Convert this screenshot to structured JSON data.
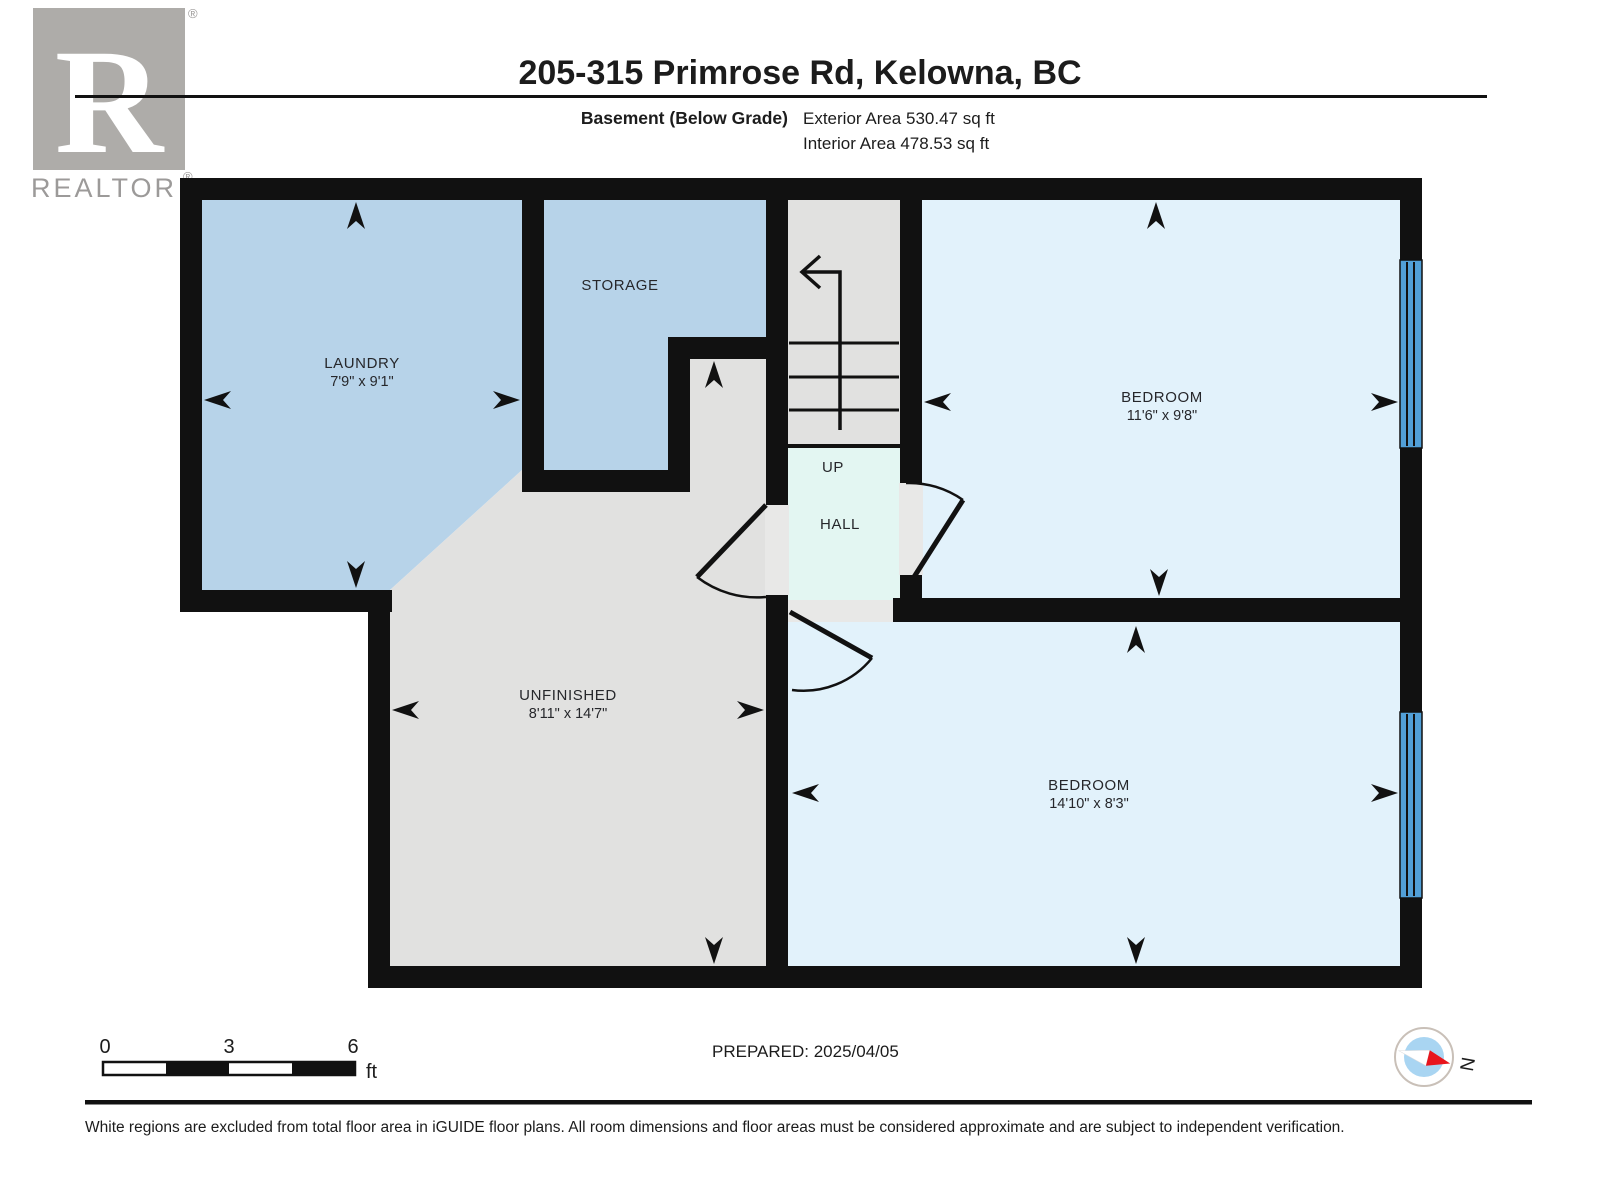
{
  "header": {
    "title": "205-315 Primrose Rd, Kelowna, BC",
    "floor_label": "Basement (Below Grade)",
    "exterior_area": "Exterior Area 530.47 sq ft",
    "interior_area": "Interior Area 478.53 sq ft"
  },
  "logo": {
    "letter": "R",
    "word": "REALTOR",
    "registered": "®"
  },
  "plan": {
    "laundry": {
      "name": "LAUNDRY",
      "dims": "7'9\" x 9'1\""
    },
    "storage": {
      "name": "STORAGE"
    },
    "bedroom1": {
      "name": "BEDROOM",
      "dims": "11'6\" x 9'8\""
    },
    "bedroom2": {
      "name": "BEDROOM",
      "dims": "14'10\" x 8'3\""
    },
    "unfinished": {
      "name": "UNFINISHED",
      "dims": "8'11\" x 14'7\""
    },
    "stairs": {
      "label": "UP"
    },
    "hall": {
      "label": "HALL"
    }
  },
  "scale_bar": {
    "start": "0",
    "mid": "3",
    "end": "6",
    "unit": "ft"
  },
  "footer": {
    "prepared": "PREPARED: 2025/04/05",
    "compass_label": "N",
    "disclaimer": "White regions are excluded from total floor area in iGUIDE floor plans. All room dimensions and floor areas must be considered approximate and are subject to independent verification."
  },
  "icons": {
    "compass": "compass-north-icon",
    "stair_direction": "stair-up-arrow-icon",
    "room_extent": "room-extent-arrow-icon"
  },
  "colors": {
    "wall": "#111111",
    "room_blue": "#b7d3e9",
    "room_light_blue": "#e2f2fb",
    "hall_mint": "#e3f6f2",
    "unfinished_gray": "#e1e1e0",
    "opening_gray": "#e8e8e7",
    "window_blue": "#519fd7",
    "logo_gray": "#aeaca9",
    "needle_red": "#e8151d",
    "compass_blue": "#a9d5f2"
  }
}
